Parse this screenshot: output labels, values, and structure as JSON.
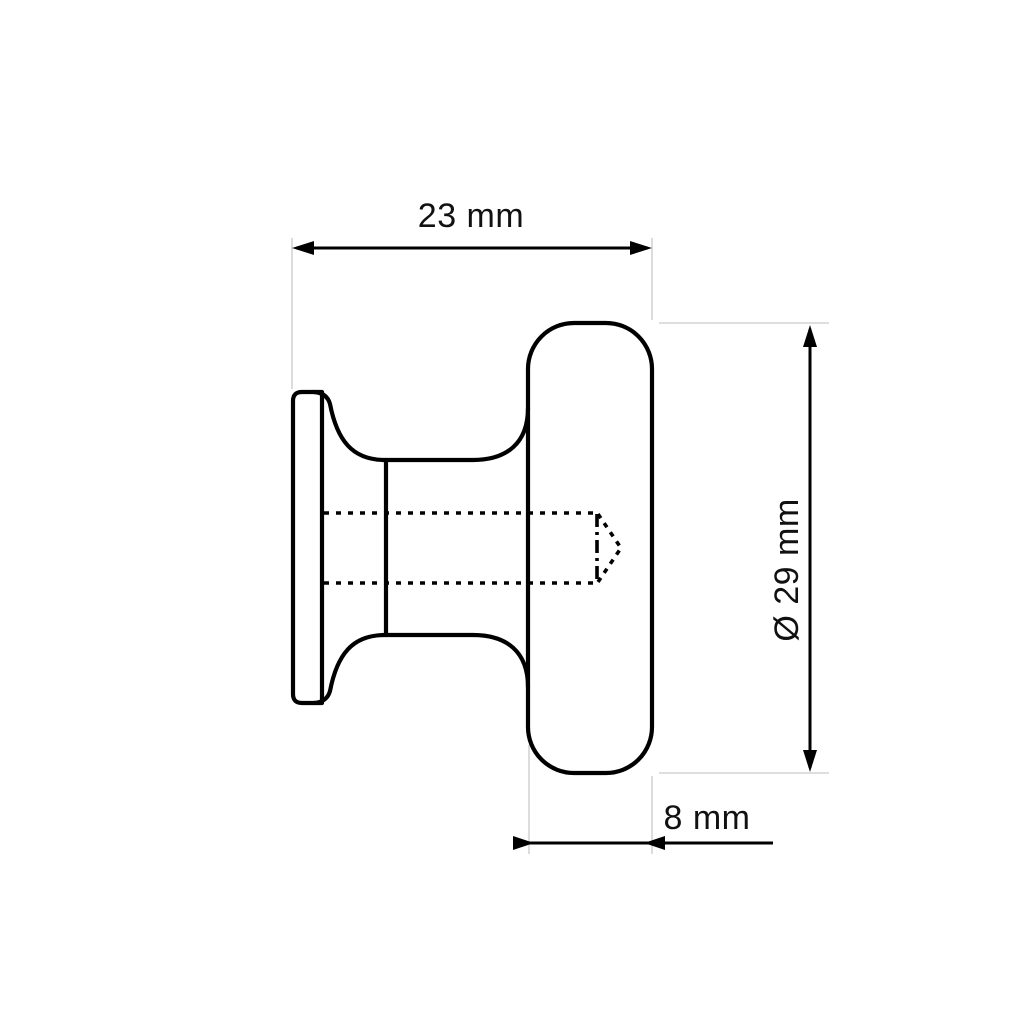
{
  "drawing": {
    "dimensions": {
      "width_label": "23 mm",
      "diameter_label": "Ø 29 mm",
      "thickness_label": "8 mm"
    },
    "colors": {
      "line": "#000000",
      "extension_line": "#d4d4d4",
      "text": "#111111",
      "background": "#ffffff"
    }
  }
}
